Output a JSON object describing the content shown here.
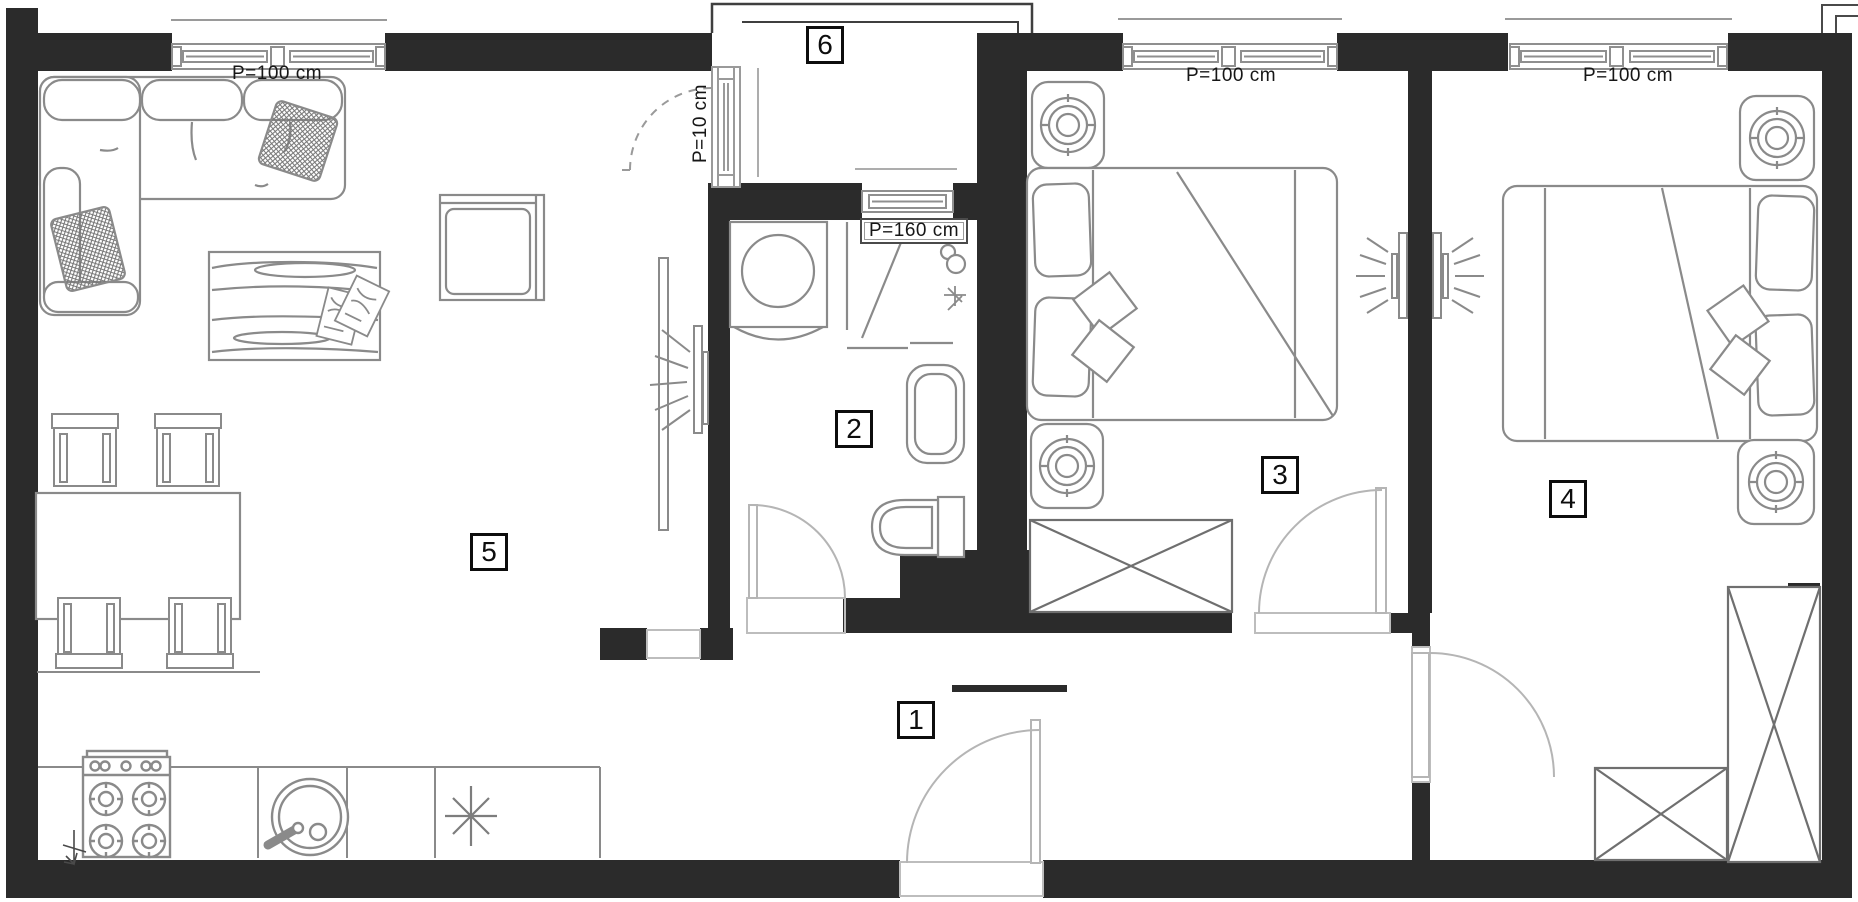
{
  "title": "apartment-floor-plan",
  "rooms": [
    {
      "number": "1"
    },
    {
      "number": "2"
    },
    {
      "number": "3"
    },
    {
      "number": "4"
    },
    {
      "number": "5"
    },
    {
      "number": "6"
    }
  ],
  "dimensions": {
    "living_window": "P=100 cm",
    "bedroom3_window": "P=100 cm",
    "bedroom4_window": "P=100 cm",
    "bathroom_window": "P=160 cm",
    "balcony_door": "P=10 cm"
  },
  "colors": {
    "wall": "#2b2b2b",
    "furniture_line": "#8a8a8a",
    "door_line": "#b5b5b5",
    "outline": "#4a4a4a",
    "text": "#161616",
    "background": "#ffffff"
  }
}
